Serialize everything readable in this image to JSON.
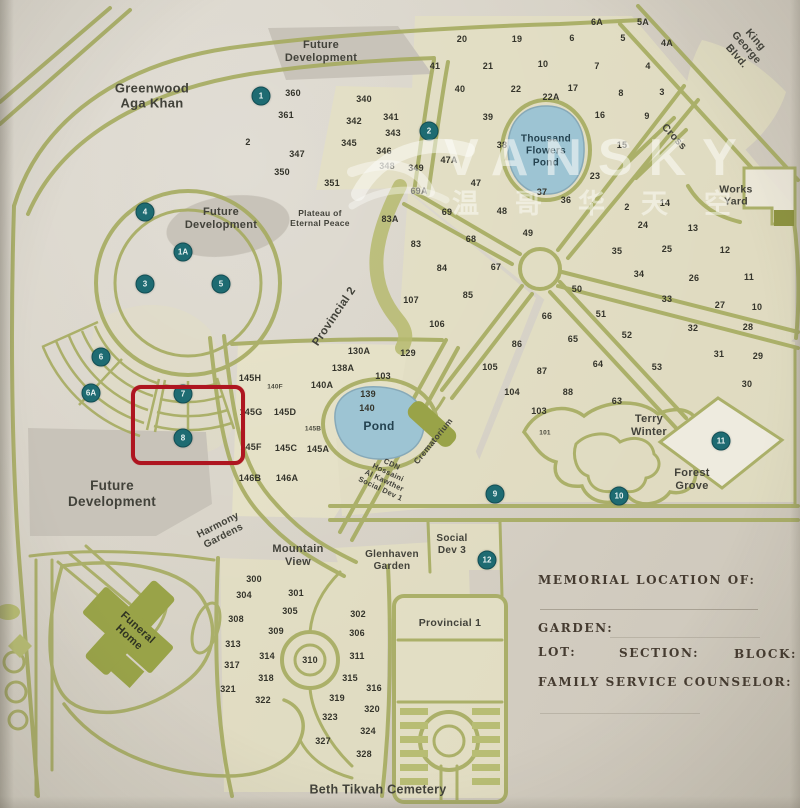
{
  "watermark": {
    "brand": "VANSKY",
    "chinese": "温哥华天空"
  },
  "form": {
    "memorial": "MEMORIAL LOCATION OF:",
    "garden": "GARDEN:",
    "lot": "LOT:",
    "section": "SECTION:",
    "block": "BLOCK:",
    "counselor": "FAMILY SERVICE COUNSELOR:"
  },
  "colors": {
    "road": "#a6ab60",
    "roadlight": "#b8bd74",
    "tint": "#e5e1c2",
    "tint2": "#ebe7ca",
    "grey": "#c8c3b9",
    "water": "#9dc4d3",
    "marker": "#1e6b72",
    "red": "#ae1520",
    "ink": "#34342b",
    "formink": "#453b30",
    "building": "#99a348"
  },
  "map": {
    "area_labels": [
      {
        "name": "label-future-development-north",
        "t": "Future\nDevelopment",
        "x": 321,
        "y": 52,
        "s": 11
      },
      {
        "name": "label-greenwood-aga-khan",
        "t": "Greenwood\nAga Khan",
        "x": 152,
        "y": 96,
        "s": 13
      },
      {
        "name": "label-future-development-central",
        "t": "Future\nDevelopment",
        "x": 221,
        "y": 219,
        "s": 11
      },
      {
        "name": "label-plateau-of-eternal-peace",
        "t": "Plateau of\nEternal Peace",
        "x": 320,
        "y": 218,
        "s": 8.5
      },
      {
        "name": "label-provincial-2",
        "t": "Provincial 2",
        "x": 335,
        "y": 317,
        "s": 11.5,
        "r": -56
      },
      {
        "name": "label-thousand-flowers-pond",
        "t": "Thousand\nFlowers\nPond",
        "x": 546,
        "y": 151,
        "s": 10,
        "c": "#24424f"
      },
      {
        "name": "label-works-yard",
        "t": "Works\nYard",
        "x": 736,
        "y": 196,
        "s": 10.5
      },
      {
        "name": "label-king-george-blvd",
        "t": "King George Blvd.",
        "x": 746,
        "y": 48,
        "s": 10.5,
        "r": 49
      },
      {
        "name": "label-cross",
        "t": "Cross",
        "x": 674,
        "y": 137,
        "s": 10.5,
        "r": 47
      },
      {
        "name": "label-terry-winter",
        "t": "Terry\nWinter",
        "x": 649,
        "y": 426,
        "s": 11
      },
      {
        "name": "label-forest-grove",
        "t": "Forest\nGrove",
        "x": 692,
        "y": 480,
        "s": 11
      },
      {
        "name": "label-pond",
        "t": "Pond",
        "x": 379,
        "y": 426,
        "s": 12,
        "c": "#24424f"
      },
      {
        "name": "label-crematorium",
        "t": "Crematorium",
        "x": 433,
        "y": 441,
        "s": 8.5,
        "r": -51
      },
      {
        "name": "label-cdn-hossaini",
        "t": "CDN\nHossaini\nAl Kawther\nSocial Dev 1",
        "x": 386,
        "y": 477,
        "s": 7.5,
        "r": 25
      },
      {
        "name": "label-future-development-west",
        "t": "Future\nDevelopment",
        "x": 112,
        "y": 494,
        "s": 13.5
      },
      {
        "name": "label-harmony-gardens",
        "t": "Harmony\nGardens",
        "x": 221,
        "y": 531,
        "s": 10,
        "r": -27
      },
      {
        "name": "label-mountain-view",
        "t": "Mountain\nView",
        "x": 298,
        "y": 556,
        "s": 11
      },
      {
        "name": "label-glenhaven-garden",
        "t": "Glenhaven\nGarden",
        "x": 392,
        "y": 561,
        "s": 10
      },
      {
        "name": "label-social-dev-3",
        "t": "Social\nDev 3",
        "x": 452,
        "y": 545,
        "s": 10
      },
      {
        "name": "label-provincial-1",
        "t": "Provincial 1",
        "x": 450,
        "y": 623,
        "s": 10.5
      },
      {
        "name": "label-beth-tikvah-cemetery",
        "t": "Beth Tikvah Cemetery",
        "x": 378,
        "y": 790,
        "s": 12.5
      },
      {
        "name": "label-funeral-home",
        "t": "Funeral\nHome",
        "x": 133,
        "y": 633,
        "s": 11,
        "r": 42,
        "c": "#2f3322"
      }
    ],
    "markers": [
      {
        "n": "1",
        "x": 261,
        "y": 96
      },
      {
        "n": "2",
        "x": 429,
        "y": 131
      },
      {
        "n": "4",
        "x": 145,
        "y": 212
      },
      {
        "n": "1A",
        "x": 183,
        "y": 252
      },
      {
        "n": "3",
        "x": 145,
        "y": 284
      },
      {
        "n": "5",
        "x": 221,
        "y": 284
      },
      {
        "n": "6",
        "x": 101,
        "y": 357
      },
      {
        "n": "6A",
        "x": 91,
        "y": 393
      },
      {
        "n": "7",
        "x": 183,
        "y": 394
      },
      {
        "n": "8",
        "x": 183,
        "y": 438
      },
      {
        "n": "9",
        "x": 495,
        "y": 494
      },
      {
        "n": "10",
        "x": 619,
        "y": 496
      },
      {
        "n": "11",
        "x": 721,
        "y": 441
      },
      {
        "n": "12",
        "x": 487,
        "y": 560
      }
    ],
    "highlight": {
      "x": 131,
      "y": 385,
      "w": 106,
      "h": 72
    },
    "plot_numbers": [
      {
        "t": "360",
        "x": 293,
        "y": 93
      },
      {
        "t": "361",
        "x": 286,
        "y": 115
      },
      {
        "t": "2",
        "x": 248,
        "y": 142
      },
      {
        "t": "340",
        "x": 364,
        "y": 99
      },
      {
        "t": "342",
        "x": 354,
        "y": 121
      },
      {
        "t": "341",
        "x": 391,
        "y": 117
      },
      {
        "t": "343",
        "x": 393,
        "y": 133
      },
      {
        "t": "345",
        "x": 349,
        "y": 143
      },
      {
        "t": "346",
        "x": 384,
        "y": 151
      },
      {
        "t": "347",
        "x": 297,
        "y": 154
      },
      {
        "t": "348",
        "x": 387,
        "y": 166
      },
      {
        "t": "349",
        "x": 416,
        "y": 168
      },
      {
        "t": "350",
        "x": 282,
        "y": 172
      },
      {
        "t": "351",
        "x": 332,
        "y": 183
      },
      {
        "t": "6A",
        "x": 597,
        "y": 22
      },
      {
        "t": "5A",
        "x": 643,
        "y": 22
      },
      {
        "t": "20",
        "x": 462,
        "y": 39
      },
      {
        "t": "19",
        "x": 517,
        "y": 39
      },
      {
        "t": "6",
        "x": 572,
        "y": 38
      },
      {
        "t": "5",
        "x": 623,
        "y": 38
      },
      {
        "t": "4A",
        "x": 667,
        "y": 43
      },
      {
        "t": "41",
        "x": 435,
        "y": 66
      },
      {
        "t": "21",
        "x": 488,
        "y": 66
      },
      {
        "t": "10",
        "x": 543,
        "y": 64
      },
      {
        "t": "7",
        "x": 597,
        "y": 66
      },
      {
        "t": "4",
        "x": 648,
        "y": 66
      },
      {
        "t": "40",
        "x": 460,
        "y": 89
      },
      {
        "t": "22",
        "x": 516,
        "y": 89
      },
      {
        "t": "22A",
        "x": 551,
        "y": 97
      },
      {
        "t": "17",
        "x": 573,
        "y": 88
      },
      {
        "t": "8",
        "x": 621,
        "y": 93
      },
      {
        "t": "3",
        "x": 662,
        "y": 92
      },
      {
        "t": "39",
        "x": 488,
        "y": 117
      },
      {
        "t": "16",
        "x": 600,
        "y": 115
      },
      {
        "t": "9",
        "x": 647,
        "y": 116
      },
      {
        "t": "38",
        "x": 502,
        "y": 145
      },
      {
        "t": "15",
        "x": 622,
        "y": 145
      },
      {
        "t": "47A",
        "x": 449,
        "y": 160
      },
      {
        "t": "47",
        "x": 476,
        "y": 183
      },
      {
        "t": "23",
        "x": 595,
        "y": 176
      },
      {
        "t": "37",
        "x": 542,
        "y": 192
      },
      {
        "t": "36",
        "x": 566,
        "y": 200
      },
      {
        "t": "69A",
        "x": 419,
        "y": 191
      },
      {
        "t": "69",
        "x": 447,
        "y": 212
      },
      {
        "t": "48",
        "x": 502,
        "y": 211
      },
      {
        "t": "49",
        "x": 528,
        "y": 233
      },
      {
        "t": "2",
        "x": 627,
        "y": 207
      },
      {
        "t": "14",
        "x": 665,
        "y": 203
      },
      {
        "t": "24",
        "x": 643,
        "y": 225
      },
      {
        "t": "13",
        "x": 693,
        "y": 228
      },
      {
        "t": "35",
        "x": 617,
        "y": 251
      },
      {
        "t": "25",
        "x": 667,
        "y": 249
      },
      {
        "t": "12",
        "x": 725,
        "y": 250
      },
      {
        "t": "34",
        "x": 639,
        "y": 274
      },
      {
        "t": "26",
        "x": 694,
        "y": 278
      },
      {
        "t": "11",
        "x": 749,
        "y": 277
      },
      {
        "t": "33",
        "x": 667,
        "y": 299
      },
      {
        "t": "27",
        "x": 720,
        "y": 305
      },
      {
        "t": "10",
        "x": 757,
        "y": 307
      },
      {
        "t": "32",
        "x": 693,
        "y": 328
      },
      {
        "t": "28",
        "x": 748,
        "y": 327
      },
      {
        "t": "31",
        "x": 719,
        "y": 354
      },
      {
        "t": "29",
        "x": 758,
        "y": 356
      },
      {
        "t": "30",
        "x": 747,
        "y": 384
      },
      {
        "t": "50",
        "x": 577,
        "y": 289
      },
      {
        "t": "51",
        "x": 601,
        "y": 314
      },
      {
        "t": "52",
        "x": 627,
        "y": 335
      },
      {
        "t": "53",
        "x": 657,
        "y": 367
      },
      {
        "t": "63",
        "x": 617,
        "y": 401
      },
      {
        "t": "64",
        "x": 598,
        "y": 364
      },
      {
        "t": "65",
        "x": 573,
        "y": 339
      },
      {
        "t": "66",
        "x": 547,
        "y": 316
      },
      {
        "t": "67",
        "x": 496,
        "y": 267
      },
      {
        "t": "68",
        "x": 471,
        "y": 239
      },
      {
        "t": "83A",
        "x": 390,
        "y": 219
      },
      {
        "t": "83",
        "x": 416,
        "y": 244
      },
      {
        "t": "84",
        "x": 442,
        "y": 268
      },
      {
        "t": "85",
        "x": 468,
        "y": 295
      },
      {
        "t": "86",
        "x": 517,
        "y": 344
      },
      {
        "t": "87",
        "x": 542,
        "y": 371
      },
      {
        "t": "88",
        "x": 568,
        "y": 392
      },
      {
        "t": "103",
        "x": 539,
        "y": 411
      },
      {
        "t": "104",
        "x": 512,
        "y": 392
      },
      {
        "t": "105",
        "x": 490,
        "y": 367
      },
      {
        "t": "106",
        "x": 437,
        "y": 324
      },
      {
        "t": "107",
        "x": 411,
        "y": 300
      },
      {
        "t": "129",
        "x": 408,
        "y": 353
      },
      {
        "t": "101",
        "x": 545,
        "y": 433,
        "sm": true
      },
      {
        "t": "130A",
        "x": 359,
        "y": 351
      },
      {
        "t": "138A",
        "x": 343,
        "y": 368
      },
      {
        "t": "103",
        "x": 383,
        "y": 376
      },
      {
        "t": "140A",
        "x": 322,
        "y": 385
      },
      {
        "t": "139",
        "x": 368,
        "y": 394
      },
      {
        "t": "140",
        "x": 367,
        "y": 408
      },
      {
        "t": "145H",
        "x": 250,
        "y": 378
      },
      {
        "t": "140F",
        "x": 275,
        "y": 387,
        "sm": true
      },
      {
        "t": "145G",
        "x": 251,
        "y": 412
      },
      {
        "t": "145D",
        "x": 285,
        "y": 412
      },
      {
        "t": "145B",
        "x": 313,
        "y": 429,
        "sm": true
      },
      {
        "t": "145F",
        "x": 251,
        "y": 447
      },
      {
        "t": "145C",
        "x": 286,
        "y": 448
      },
      {
        "t": "145A",
        "x": 318,
        "y": 449
      },
      {
        "t": "146B",
        "x": 250,
        "y": 478
      },
      {
        "t": "146A",
        "x": 287,
        "y": 478
      },
      {
        "t": "300",
        "x": 254,
        "y": 579
      },
      {
        "t": "301",
        "x": 296,
        "y": 593
      },
      {
        "t": "304",
        "x": 244,
        "y": 595
      },
      {
        "t": "305",
        "x": 290,
        "y": 611
      },
      {
        "t": "302",
        "x": 358,
        "y": 614
      },
      {
        "t": "308",
        "x": 236,
        "y": 619
      },
      {
        "t": "309",
        "x": 276,
        "y": 631
      },
      {
        "t": "306",
        "x": 357,
        "y": 633
      },
      {
        "t": "313",
        "x": 233,
        "y": 644
      },
      {
        "t": "314",
        "x": 267,
        "y": 656
      },
      {
        "t": "310",
        "x": 310,
        "y": 660
      },
      {
        "t": "311",
        "x": 357,
        "y": 656
      },
      {
        "t": "317",
        "x": 232,
        "y": 665
      },
      {
        "t": "318",
        "x": 266,
        "y": 678
      },
      {
        "t": "315",
        "x": 350,
        "y": 678
      },
      {
        "t": "316",
        "x": 374,
        "y": 688
      },
      {
        "t": "321",
        "x": 228,
        "y": 689
      },
      {
        "t": "322",
        "x": 263,
        "y": 700
      },
      {
        "t": "319",
        "x": 337,
        "y": 698
      },
      {
        "t": "320",
        "x": 372,
        "y": 709
      },
      {
        "t": "323",
        "x": 330,
        "y": 717
      },
      {
        "t": "324",
        "x": 368,
        "y": 731
      },
      {
        "t": "327",
        "x": 323,
        "y": 741
      },
      {
        "t": "328",
        "x": 364,
        "y": 754
      }
    ]
  }
}
